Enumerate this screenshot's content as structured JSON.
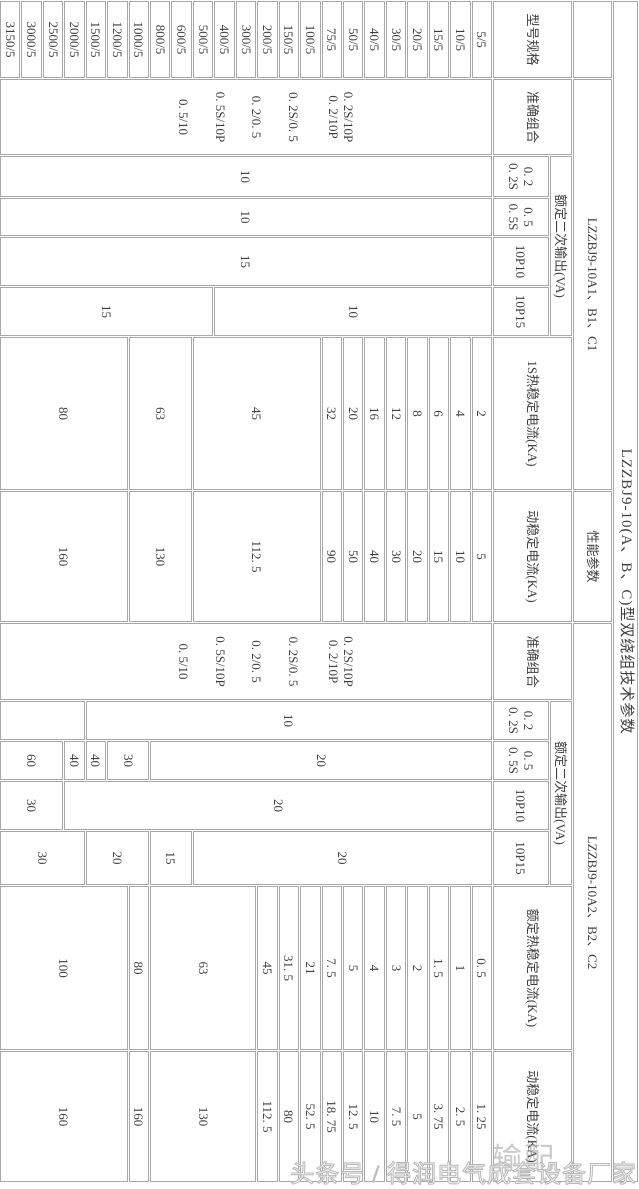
{
  "watermark": "输配",
  "footer": {
    "credit": "头条号 / 得润电气成套设备厂家"
  },
  "table": {
    "title": "LZZBJ9-10(A、B、C)型双绕组技术参数",
    "perf_label": "性能参数",
    "model_header": "型号规格",
    "models": [
      "5/5",
      "10/5",
      "15/5",
      "20/5",
      "30/5",
      "40/5",
      "50/5",
      "75/5",
      "100/5",
      "150/5",
      "200/5",
      "300/5",
      "400/5",
      "500/5",
      "600/5",
      "800/5",
      "1000/5",
      "1200/5",
      "1500/5",
      "2000/5",
      "2500/5",
      "3000/5",
      "3150/5"
    ],
    "sections": [
      {
        "group_label": "LZZBJ9-10A1、B1、C1",
        "accuracy": {
          "header": "准确组合",
          "labels": [
            {
              "lines": [
                "0. 2S/10P",
                "0. 2/10P"
              ],
              "frac": 0.306
            },
            {
              "lines": [
                "0. 2S/0. 5"
              ],
              "frac": 0.402
            },
            {
              "lines": [
                "0. 2/0. 5"
              ],
              "frac": 0.477
            },
            {
              "lines": [
                "0. 5S/10P"
              ],
              "frac": 0.55
            },
            {
              "lines": [
                "0. 5/10"
              ],
              "frac": 0.625
            }
          ]
        },
        "va": {
          "header": "额定二次输出(VA)",
          "rows": [
            {
              "label": [
                "0. 2",
                "0. 2S"
              ],
              "cells": [
                [
                  "10",
                  23
                ]
              ]
            },
            {
              "label": [
                "0. 5",
                "0. 5S"
              ],
              "cells": [
                [
                  "10",
                  23
                ]
              ]
            },
            {
              "label": [
                "10P10"
              ],
              "cells": [
                [
                  "15",
                  23
                ]
              ]
            },
            {
              "label": [
                "10P15"
              ],
              "cells": [
                [
                  "10",
                  13
                ],
                [
                  "15",
                  10
                ]
              ]
            }
          ]
        },
        "thermal": {
          "header": "1S热稳定电流(KA)",
          "cells": [
            [
              "2",
              1
            ],
            [
              "4",
              1
            ],
            [
              "6",
              1
            ],
            [
              "8",
              1
            ],
            [
              "12",
              1
            ],
            [
              "16",
              1
            ],
            [
              "20",
              1
            ],
            [
              "32",
              1
            ],
            [
              "45",
              6
            ],
            [
              "63",
              3
            ],
            [
              "80",
              6
            ]
          ]
        },
        "dynamic": {
          "header": "动稳定电流(KA)",
          "cells": [
            [
              "5",
              1
            ],
            [
              "10",
              1
            ],
            [
              "15",
              1
            ],
            [
              "20",
              1
            ],
            [
              "30",
              1
            ],
            [
              "40",
              1
            ],
            [
              "50",
              1
            ],
            [
              "90",
              1
            ],
            [
              "112. 5",
              6
            ],
            [
              "130",
              3
            ],
            [
              "160",
              6
            ]
          ]
        }
      },
      {
        "group_label": "LZZBJ9-10A2、B2、C2",
        "accuracy": {
          "header": "准确组合",
          "labels": [
            {
              "lines": [
                "0. 2S/10P",
                "0. 2/10P"
              ],
              "frac": 0.306
            },
            {
              "lines": [
                "0. 2S/0. 5"
              ],
              "frac": 0.402
            },
            {
              "lines": [
                "0. 2/0. 5"
              ],
              "frac": 0.477
            },
            {
              "lines": [
                "0. 5S/10P"
              ],
              "frac": 0.55
            },
            {
              "lines": [
                "0. 5/10"
              ],
              "frac": 0.625
            }
          ]
        },
        "va": {
          "header": "额定二次输出(VA)",
          "rows": [
            {
              "label": [
                "0. 2",
                "0. 2S"
              ],
              "cells": [
                [
                  "10",
                  19
                ],
                [
                  "",
                  4
                ]
              ]
            },
            {
              "label": [
                "0. 5",
                "0. 5S"
              ],
              "cells": [
                [
                  "20",
                  16
                ],
                [
                  "30",
                  2
                ],
                [
                  "40",
                  1
                ],
                [
                  "40",
                  1
                ],
                [
                  "60",
                  3
                ]
              ]
            },
            {
              "label": [
                "10P10"
              ],
              "cells": [
                [
                  "20",
                  20
                ],
                [
                  "30",
                  3
                ]
              ]
            },
            {
              "label": [
                "10P15"
              ],
              "cells": [
                [
                  "20",
                  14
                ],
                [
                  "15",
                  2
                ],
                [
                  "20",
                  3
                ],
                [
                  "30",
                  4
                ]
              ]
            }
          ]
        },
        "thermal": {
          "header": "额定热稳定电流(KA)",
          "cells": [
            [
              "0. 5",
              1
            ],
            [
              "1",
              1
            ],
            [
              "1. 5",
              1
            ],
            [
              "2",
              1
            ],
            [
              "3",
              1
            ],
            [
              "4",
              1
            ],
            [
              "5",
              1
            ],
            [
              "7. 5",
              1
            ],
            [
              "21",
              1
            ],
            [
              "31. 5",
              1
            ],
            [
              "45",
              1
            ],
            [
              "63",
              5
            ],
            [
              "80",
              1
            ],
            [
              "100",
              6
            ]
          ]
        },
        "dynamic": {
          "header": "动稳定电流(KA)",
          "cells": [
            [
              "1. 25",
              1
            ],
            [
              "2. 5",
              1
            ],
            [
              "3. 75",
              1
            ],
            [
              "5",
              1
            ],
            [
              "7. 5",
              1
            ],
            [
              "10",
              1
            ],
            [
              "12. 5",
              1
            ],
            [
              "18. 75",
              1
            ],
            [
              "52. 5",
              1
            ],
            [
              "80",
              1
            ],
            [
              "112. 5",
              1
            ],
            [
              "130",
              5
            ],
            [
              "160",
              1
            ],
            [
              "160",
              6
            ]
          ]
        }
      }
    ]
  }
}
